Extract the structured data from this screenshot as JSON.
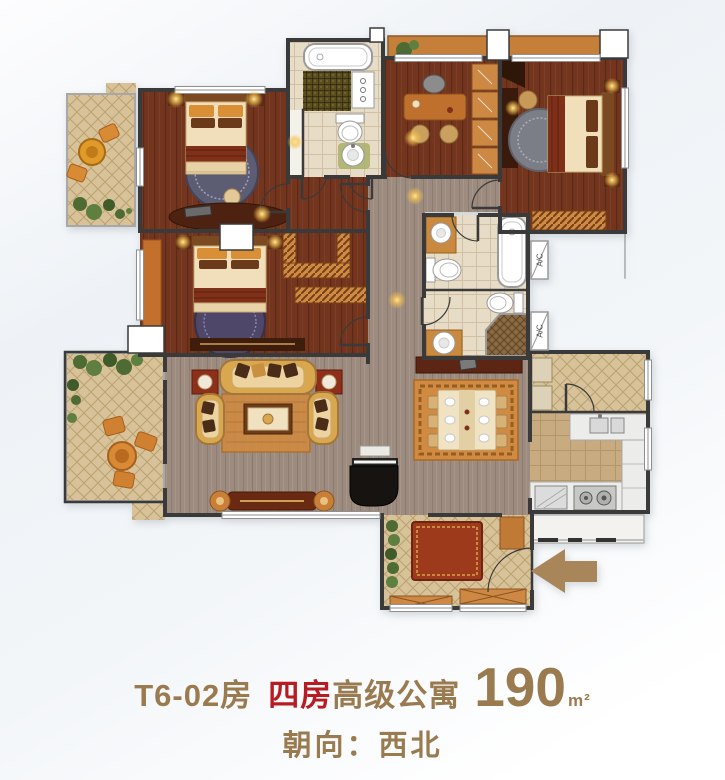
{
  "caption": {
    "unit": "T6-02房",
    "highlight": "四房",
    "type_suffix": "高级公寓",
    "area_value": "190",
    "area_unit": "m²",
    "orientation": "朝向：西北"
  },
  "plan": {
    "ac_label": "A/C"
  },
  "palette": {
    "caption_text": "#9a7b50",
    "caption_highlight": "#b71c22",
    "arrow": "#a9855a",
    "wall": "#3a3a3a",
    "wood_dark": "#74351e",
    "floor_taupe": "#9c8b7e",
    "tile_beige": "#d8c29a",
    "tile_line": "#b1955f",
    "kitchen_floor": "#c9ab80",
    "bath_floor": "#e7dcc6",
    "mosaic_olive": "#5a4e1e",
    "closet_orange": "#d08a42",
    "entry_rug": "#9c3a1b",
    "sofa_tan": "#d9a84e",
    "plant_green": "#4d6b33",
    "balcony_orange": "#c67f39"
  }
}
